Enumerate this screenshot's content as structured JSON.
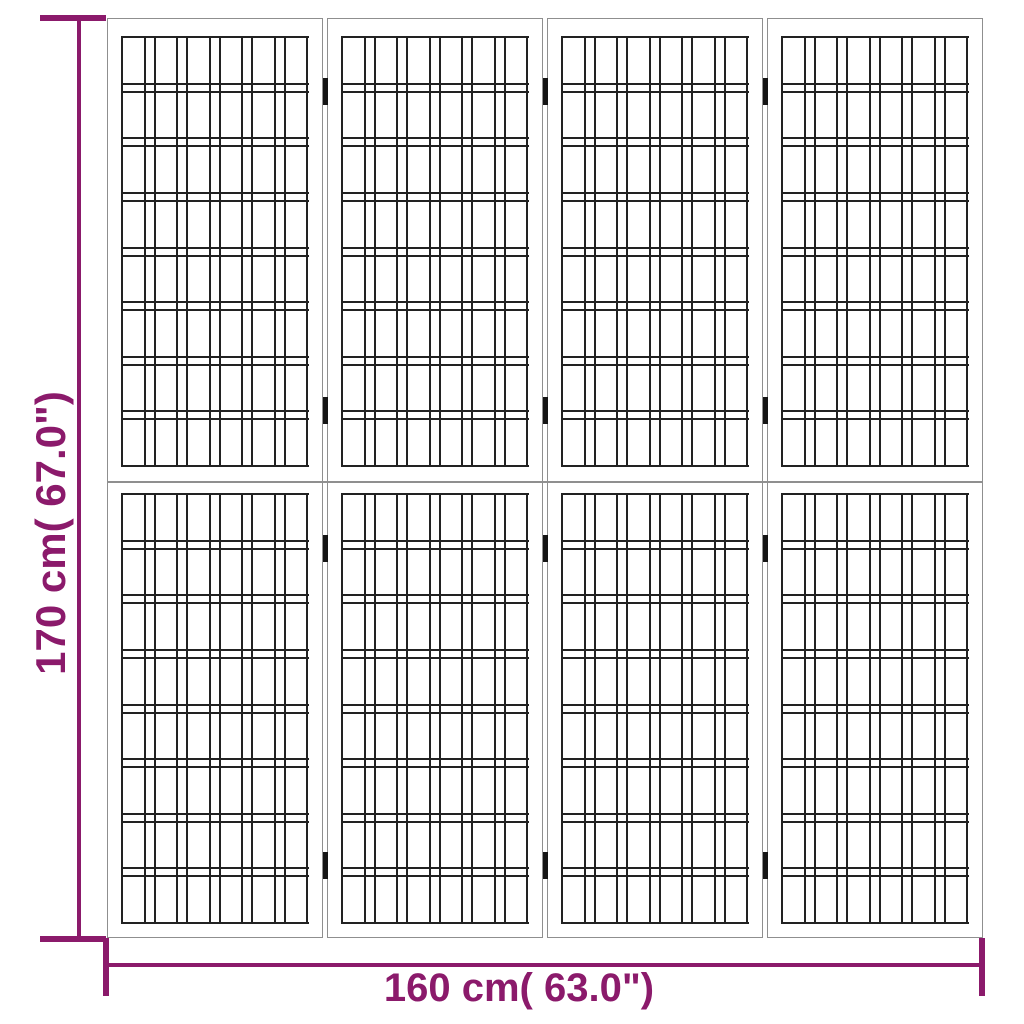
{
  "dimensions": {
    "height_label": "170 cm( 67.0\")",
    "width_label": "160 cm( 63.0\")",
    "accent_color": "#8B1A6B"
  },
  "figure": {
    "type": "folding-room-divider-dimension-diagram",
    "panel_count": 4,
    "columns_per_panel": 6,
    "rows_per_section": 8,
    "bands_per_section": 7,
    "sections_per_panel": 2,
    "hinge_joints": 3,
    "hinges_per_joint": 4,
    "background": "#ffffff",
    "frame_line_color": "#8f8f8f",
    "lattice_line_color": "#222222",
    "hinge_color": "#151515"
  }
}
